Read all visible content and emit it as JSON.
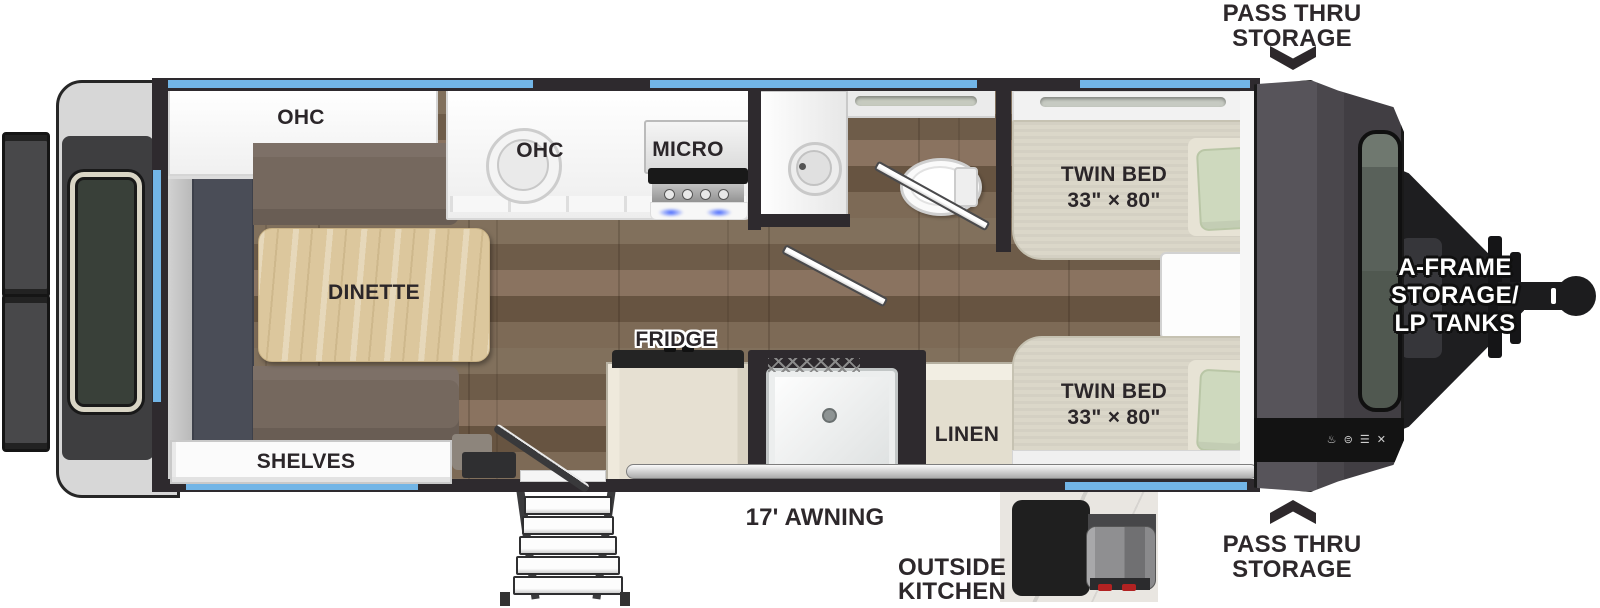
{
  "meta": {
    "title": "Travel trailer floor plan",
    "width": 1600,
    "height": 608
  },
  "colors": {
    "wall": "#2e2a2e",
    "window_blue": "#72b5e6",
    "label": "#2b2629",
    "floor_wood": "#7a6753",
    "cushion": "#75685e",
    "table_wood": "#dcc79d",
    "mattress": "#dbd7c9",
    "pillow_green": "#ced9be",
    "cabinet_beige": "#e6e0d2",
    "front_cap": "#4a474c",
    "hitch_black": "#1c1c1e"
  },
  "callouts": {
    "pass_thru_top": {
      "line1": "PASS THRU",
      "line2": "STORAGE"
    },
    "pass_thru_bottom": {
      "line1": "PASS THRU",
      "line2": "STORAGE"
    },
    "a_frame": {
      "line1": "A-FRAME",
      "line2": "STORAGE/",
      "line3": "LP TANKS"
    },
    "awning": "17' AWNING",
    "outside_kitchen": {
      "line1": "OUTSIDE",
      "line2": "KITCHEN"
    }
  },
  "rooms": {
    "ohc_rear": "OHC",
    "ohc_kitchen": "OHC",
    "micro": "MICRO",
    "dinette": "DINETTE",
    "shelves": "SHELVES",
    "fridge": "FRIDGE",
    "linen": "LINEN",
    "bed_top": {
      "line1": "TWIN BED",
      "line2": "33\" × 80\""
    },
    "bed_bottom": {
      "line1": "TWIN BED",
      "line2": "33\" × 80\""
    }
  },
  "brand_icons": "♨ ⊜ ☰ ✕"
}
